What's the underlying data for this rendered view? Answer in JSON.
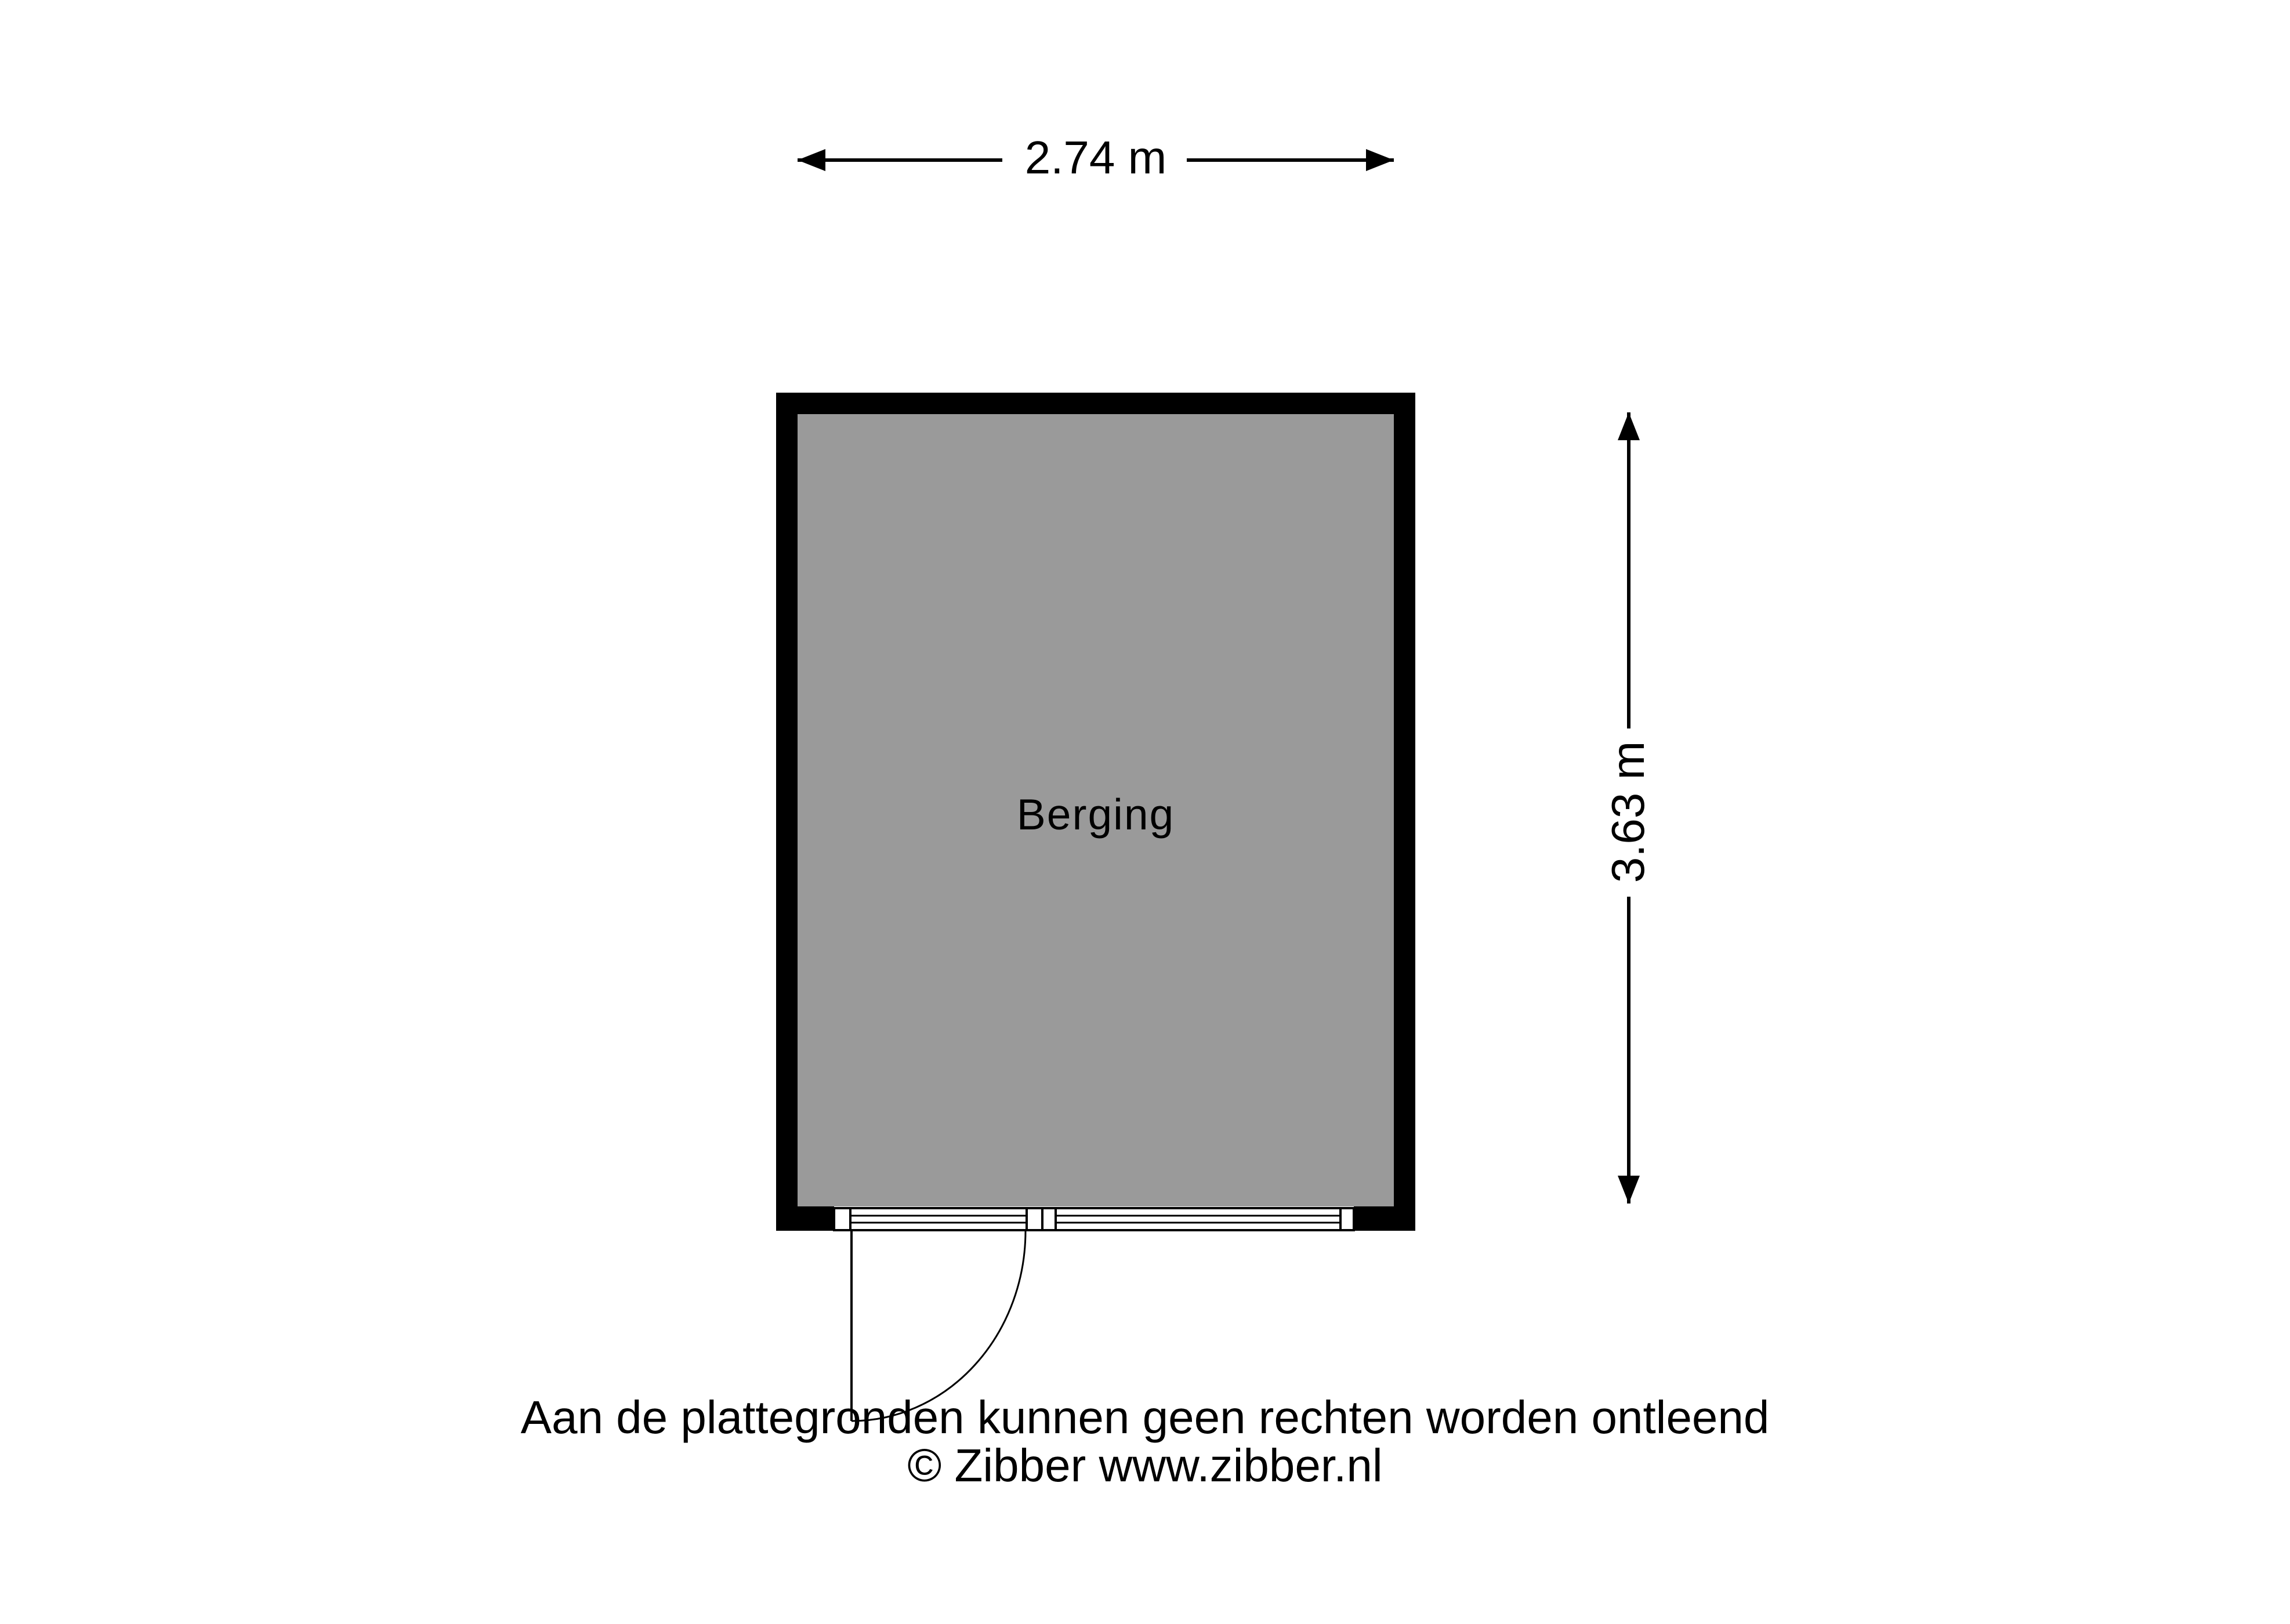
{
  "plan": {
    "room_label": "Berging",
    "width_dimension_label": "2.74 m",
    "height_dimension_label": "3.63 m"
  },
  "footer": {
    "disclaimer": "Aan de plattegronden kunnen geen rechten worden ontleend",
    "copyright": "© Zibber www.zibber.nl"
  },
  "colors": {
    "background": "#FFFFFF",
    "room_fill": "#9A9A9A",
    "wall": "#000000",
    "line": "#000000"
  }
}
